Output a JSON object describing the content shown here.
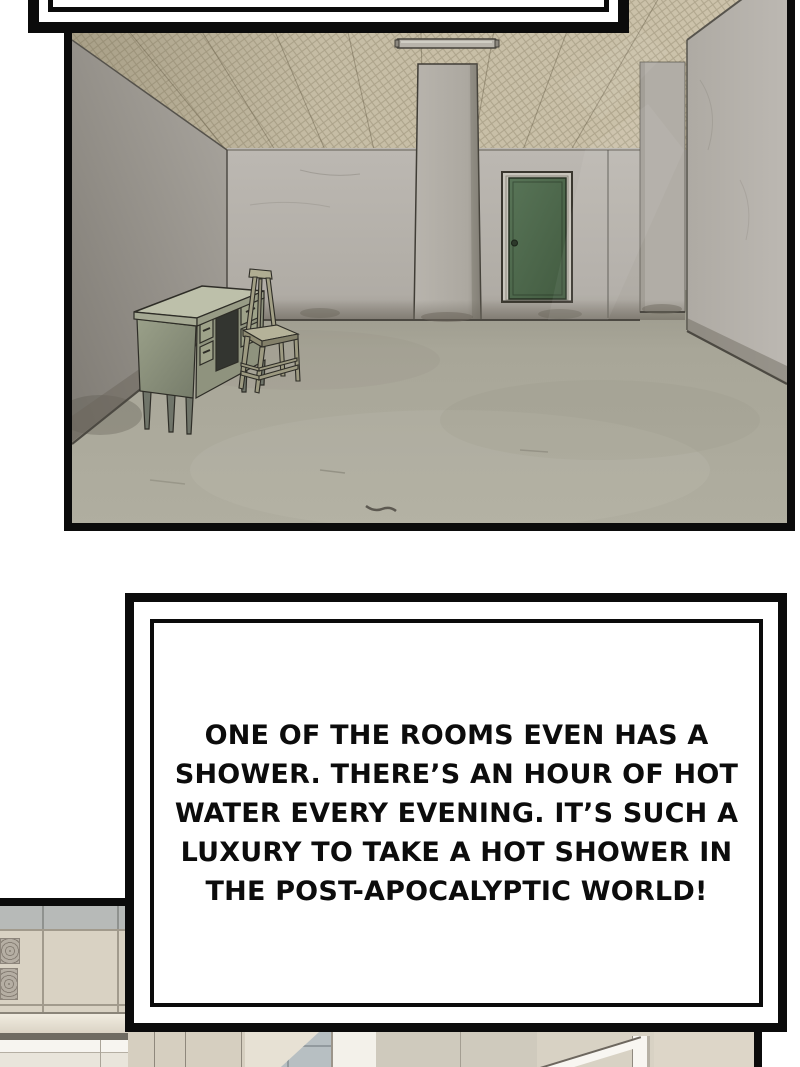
{
  "narration": {
    "lines": [
      "ONE OF THE ROOMS EVEN HAS A",
      "SHOWER. THERE’S AN HOUR OF HOT",
      "WATER EVERY EVENING. IT’S SUCH A",
      "LUXURY TO TAKE A HOT SHOWER IN",
      "THE POST-APOCALYPTIC WORLD!"
    ]
  },
  "colors": {
    "page_background": "#ffffff",
    "panel_border": "#0b0b0b",
    "door_green": "#4e6b50",
    "wall_gray": "#b5b1ab",
    "ceiling_tan": "#c6bda5",
    "floor_gray": "#a8a698",
    "desk_olive": "#8f937e",
    "bath_tile_beige": "#d9d2c3",
    "bath_tile_blue_gray": "#b7bfc2"
  }
}
